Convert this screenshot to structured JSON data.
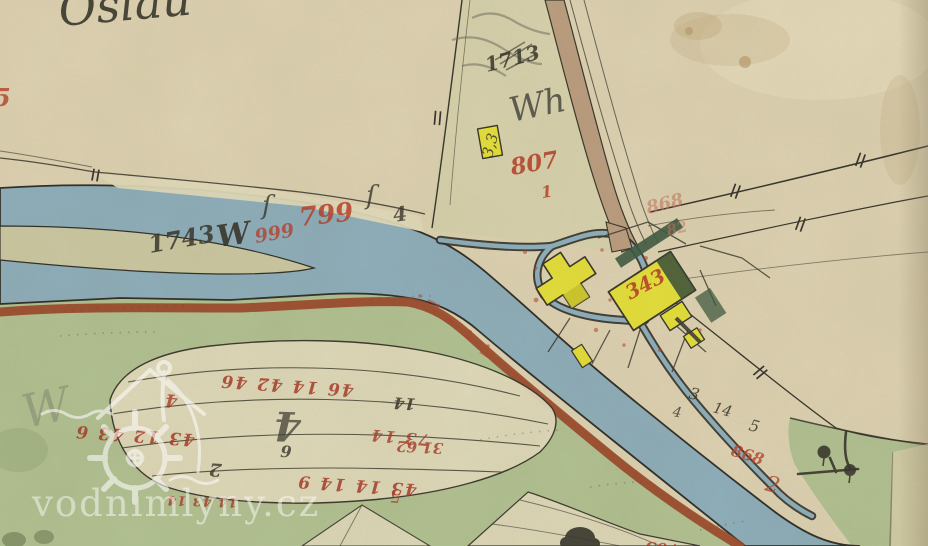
{
  "watermark": {
    "text": "vodnimlyny.cz",
    "logo": "water-mill-logo"
  },
  "map": {
    "type": "historical-cadastral-map",
    "subject": "water mill complex on a river bend",
    "colors": {
      "paper": "#ddd2b2",
      "paper_light": "#e7debf",
      "river": "#8fafbb",
      "river_edge": "#33322a",
      "island": "#cbc8a2",
      "meadow": "#b2c192",
      "parcel": "#e0dabb",
      "road_red": "#9c4a2b",
      "road_tan": "#bb9e80",
      "building_yellow": "#e3de3b",
      "garden_green": "#415c42",
      "ink": "#3a382d",
      "ink_red": "#b8432c",
      "ink_red_faded": "#c57a63",
      "ink_red_dark": "#a83d2a",
      "pencil": "#6b6a5e",
      "watermark": "#ffffff"
    },
    "annotations": [
      {
        "text": "Oslau",
        "color": "#3a382d"
      },
      {
        "text": "5",
        "color": "#b8432c"
      },
      {
        "text": "1743",
        "color": "#3a382d"
      },
      {
        "text": "W",
        "color": "#3a382d"
      },
      {
        "text": "999",
        "color": "#b8432c"
      },
      {
        "text": "799",
        "color": "#b8432c"
      },
      {
        "text": "4",
        "color": "#3a382d"
      },
      {
        "text": "ſ",
        "color": "#3a382d"
      },
      {
        "text": "ſ",
        "color": "#3a382d"
      },
      {
        "text": "1713",
        "color": "#3a382d"
      },
      {
        "text": "Wh",
        "color": "#41403a"
      },
      {
        "text": "3,3",
        "color": "#3a382d"
      },
      {
        "text": "807",
        "color": "#b8432c"
      },
      {
        "text": "1",
        "color": "#b8432c"
      },
      {
        "text": "868",
        "color": "#c57a63"
      },
      {
        "text": "82",
        "color": "#c57a63"
      },
      {
        "text": "343",
        "color": "#b8432c"
      },
      {
        "text": "3",
        "color": "#3a382d"
      },
      {
        "text": "14",
        "color": "#3a382d"
      },
      {
        "text": "5",
        "color": "#3a382d"
      },
      {
        "text": "4",
        "color": "#3a382d"
      },
      {
        "text": "868",
        "color": "#b8432c"
      },
      {
        "text": "2",
        "color": "#b8432c"
      },
      {
        "text": "46 14 42 46",
        "color": "#a83d2a"
      },
      {
        "text": "14",
        "color": "#3a382d"
      },
      {
        "text": "43 12 43 6",
        "color": "#a83d2a"
      },
      {
        "text": "73 14",
        "color": "#a83d2a"
      },
      {
        "text": "43 14 14 9",
        "color": "#a83d2a"
      },
      {
        "text": "14 43 14",
        "color": "#a83d2a"
      },
      {
        "text": "4",
        "color": "#a83d2a"
      },
      {
        "text": "4",
        "color": "#3a382d"
      },
      {
        "text": "6",
        "color": "#3a382d"
      },
      {
        "text": "2",
        "color": "#3a382d"
      },
      {
        "text": "31 62",
        "color": "#a83d2a"
      },
      {
        "text": "5",
        "color": "#a83d2a"
      },
      {
        "text": "703",
        "color": "#a83d2a"
      },
      {
        "text": "W",
        "color": "#6b6a5e"
      }
    ]
  }
}
